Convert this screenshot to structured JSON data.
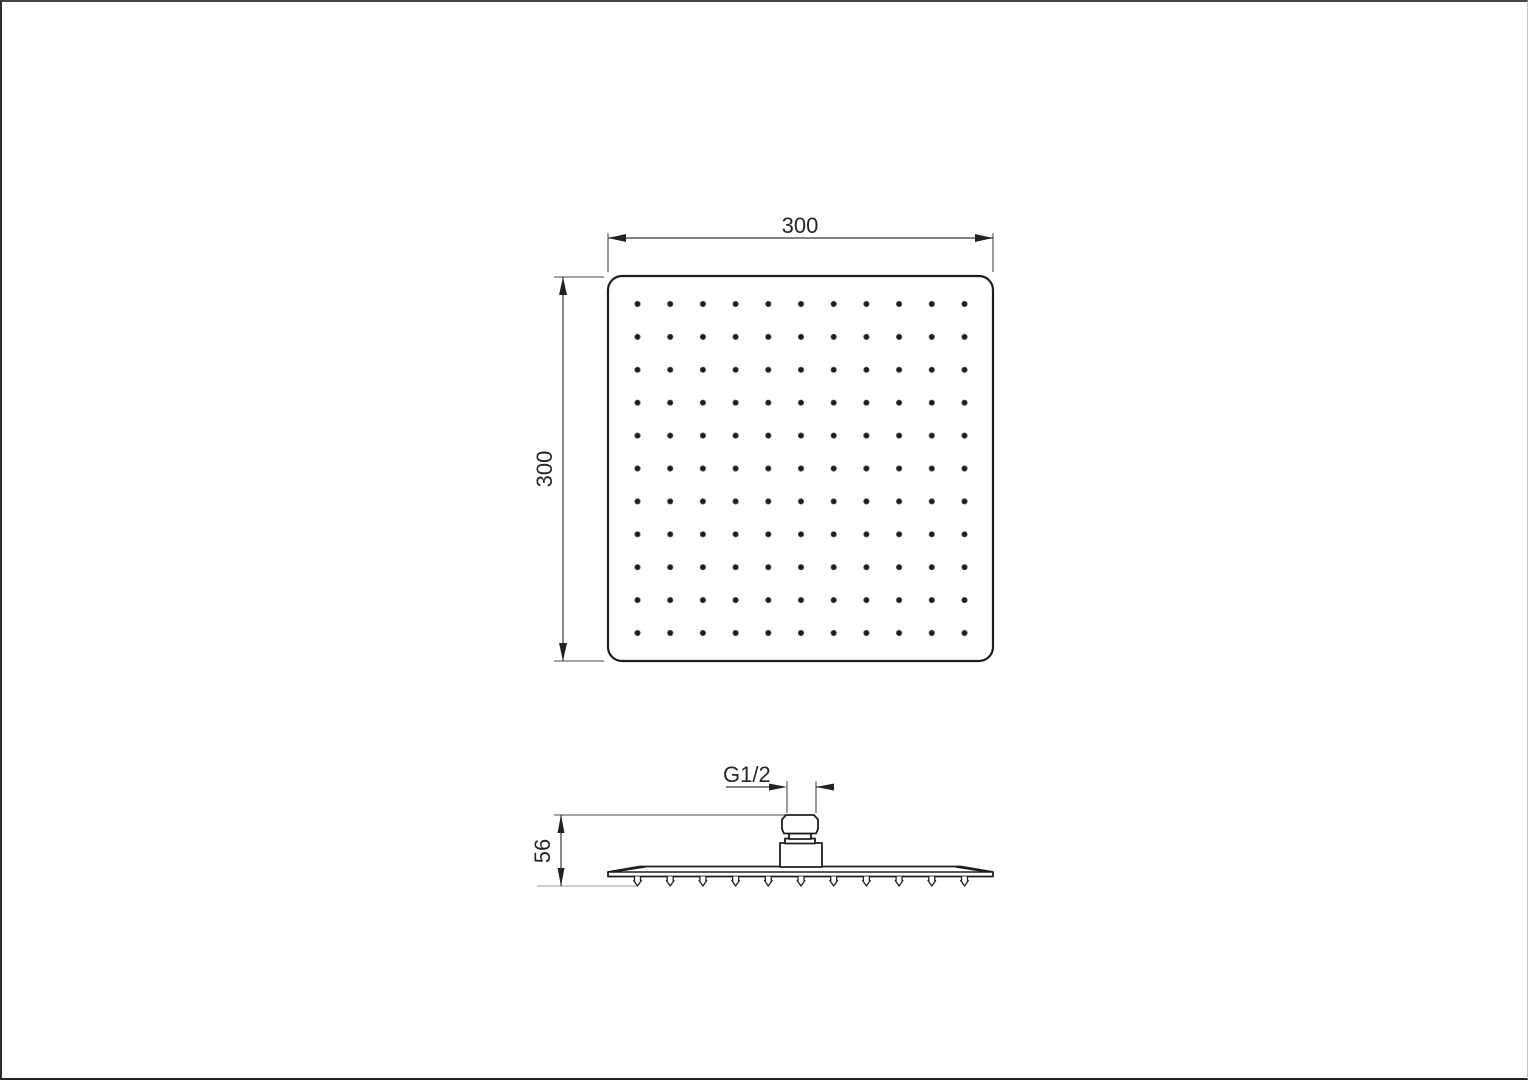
{
  "drawing": {
    "kind": "shower-head-technical-drawing",
    "background": "#ffffff",
    "line_color": "#1e1e1e"
  },
  "top_view": {
    "width_label": "300",
    "height_label": "300",
    "hole_grid": {
      "rows": 11,
      "cols": 11
    }
  },
  "side_view": {
    "height_label": "56",
    "thread_label": "G1/2",
    "nozzle_count": 11
  }
}
